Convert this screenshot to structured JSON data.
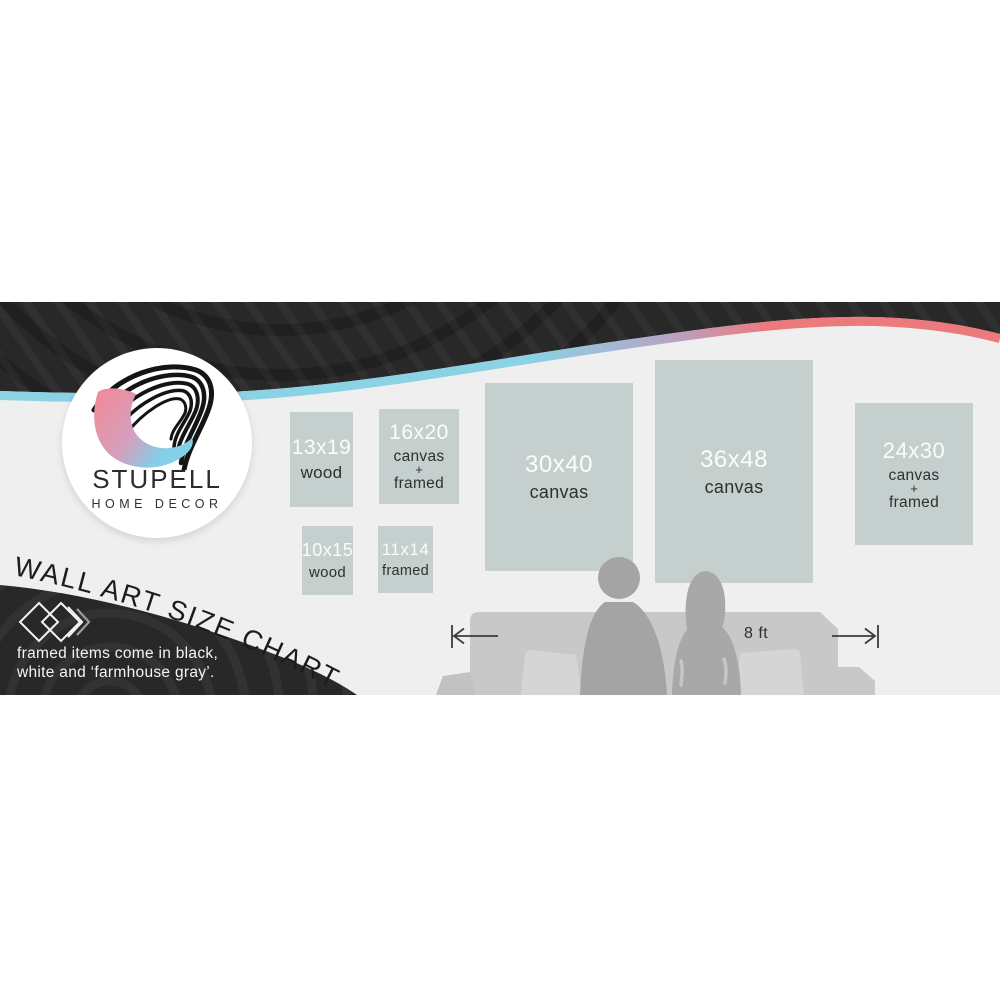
{
  "brand": {
    "name": "STUPELL",
    "subtitle": "HOME DECOR"
  },
  "title": "WALL ART SIZE CHART",
  "note": {
    "line1": "framed items come in black,",
    "line2": "white and ‘farmhouse gray’."
  },
  "measurement": {
    "label": "8 ft"
  },
  "boxes": [
    {
      "size": "13x19",
      "lines": [
        "wood"
      ]
    },
    {
      "size": "16x20",
      "lines": [
        "canvas",
        "+",
        "framed"
      ]
    },
    {
      "size": "10x15",
      "lines": [
        "wood"
      ]
    },
    {
      "size": "11x14",
      "lines": [
        "framed"
      ]
    },
    {
      "size": "30x40",
      "lines": [
        "canvas"
      ]
    },
    {
      "size": "36x48",
      "lines": [
        "canvas"
      ]
    },
    {
      "size": "24x30",
      "lines": [
        "canvas",
        "+",
        "framed"
      ]
    }
  ],
  "icons": {
    "double_diamond": "◇◇»",
    "left_measure_arrow": "|←",
    "right_measure_arrow": "→|"
  },
  "colors": {
    "accent_blue": "#8ad2e4",
    "accent_coral": "#ec797c",
    "dark_swoosh": "#282828",
    "wall": "#efefef",
    "panel": "#c4cfce",
    "couch": "#c8c8c8",
    "silhouette": "#a6a6a6",
    "logo_pink": "#ef8c9b",
    "logo_blue": "#7fd3ec"
  }
}
